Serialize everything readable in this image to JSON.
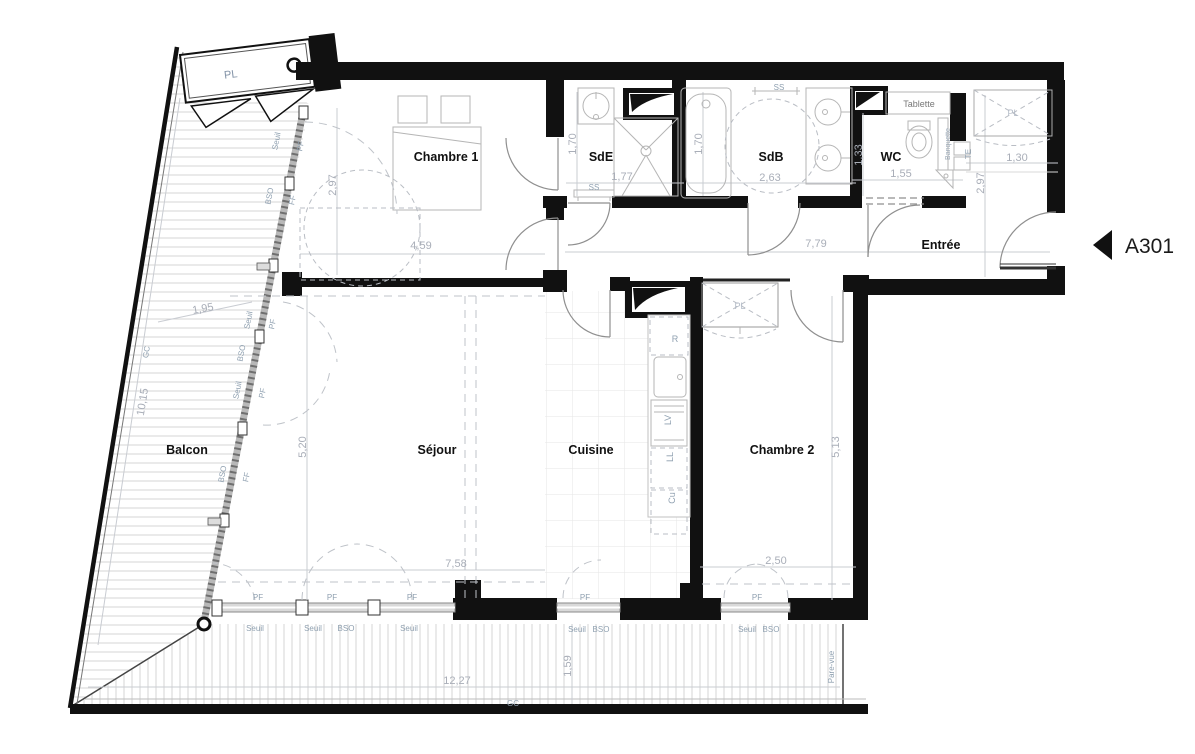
{
  "unit": {
    "id": "A301"
  },
  "rooms": {
    "chambre1": "Chambre 1",
    "sde": "SdE",
    "sdb": "SdB",
    "wc": "WC",
    "entree": "Entrée",
    "balcon": "Balcon",
    "sejour": "Séjour",
    "cuisine": "Cuisine",
    "chambre2": "Chambre 2"
  },
  "dims": {
    "chambre1_h": "2,97",
    "chambre1_w": "4,59",
    "sde_h": "1,70",
    "sde_w": "1,77",
    "sdb_h": "1,70",
    "sdb_w": "2,63",
    "wc_h": "1,33",
    "wc_w": "1,55",
    "entree_w": "1,30",
    "entree_h": "2,97",
    "couloir_w": "7,79",
    "sejour_h": "5,20",
    "sejour_w": "7,58",
    "chambre2_h": "5,13",
    "chambre2_w": "2,50",
    "balcon_w": "1,95",
    "balcon_l": "10,15",
    "terrasse_w": "12,27",
    "terrasse_h": "1,59"
  },
  "tags": {
    "pl": "PL",
    "seuil": "Seuil",
    "pf": "PF",
    "bso": "BSO",
    "ff": "FF",
    "ss": "SS",
    "gc": "GC",
    "te": "TE",
    "tablette": "Tablette",
    "banquette": "Banquette",
    "pare_vue": "Pare-vue",
    "refrigerateur": "R",
    "lave_vaisselle": "LV",
    "lave_linge": "LL",
    "cuisson": "Cu"
  },
  "colors": {
    "wall": "#111111",
    "dim_text": "#a9aeb8",
    "tag_text": "#8fa0b0",
    "hatch": "#d6d6d6"
  }
}
